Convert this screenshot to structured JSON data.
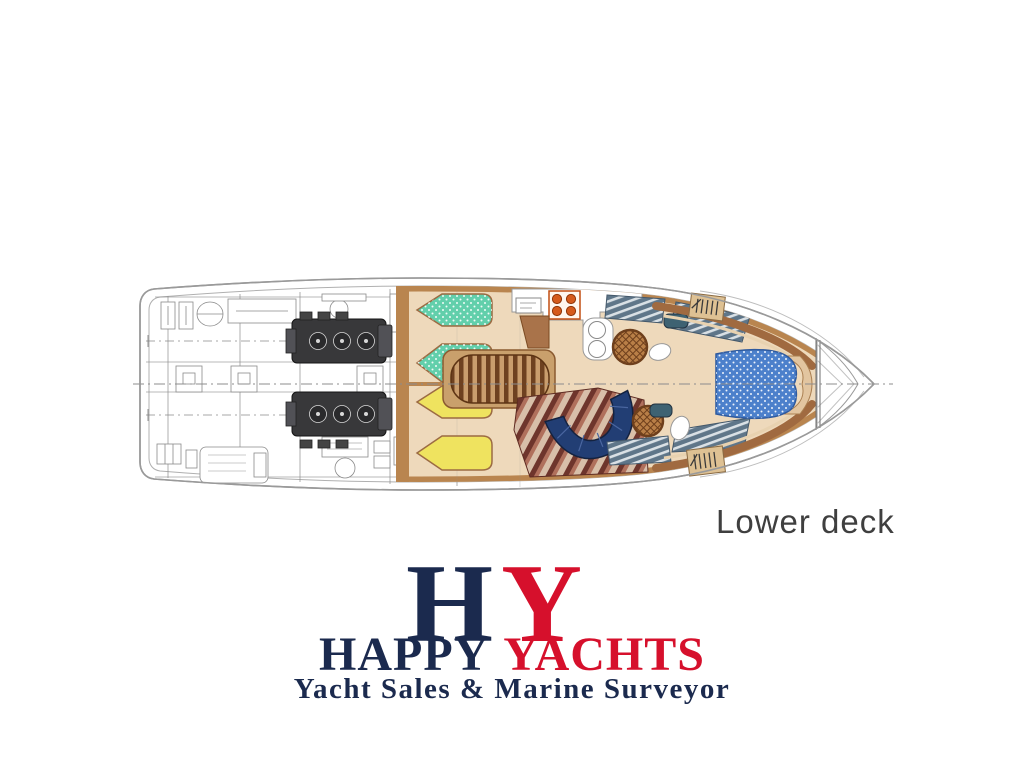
{
  "page": {
    "background_color": "#ffffff"
  },
  "plan": {
    "caption": "Lower deck",
    "caption_color": "#3f3f3f",
    "colors": {
      "hull_outline": "#9a9a9a",
      "wood_trim": "#b9854f",
      "floor_beige": "#eed9bb",
      "berth_teal": "#62cfab",
      "berth_yellow": "#efe35f",
      "vip_bed_blue": "#4c80cb",
      "sofa_navy": "#223e74",
      "stove_orange": "#d55a1c",
      "head_floor_gray": "#5f7689",
      "dinette_carpet_red": "#6e352c",
      "engine_line_gray": "#8a8a8a"
    }
  },
  "logo": {
    "monogram_h": "H",
    "monogram_y": "Y",
    "word_happy": "HAPPY",
    "word_yachts": "YACHTS",
    "tagline": "Yacht Sales & Marine Surveyor",
    "navy": "#1b2a4e",
    "red": "#d6102c"
  }
}
